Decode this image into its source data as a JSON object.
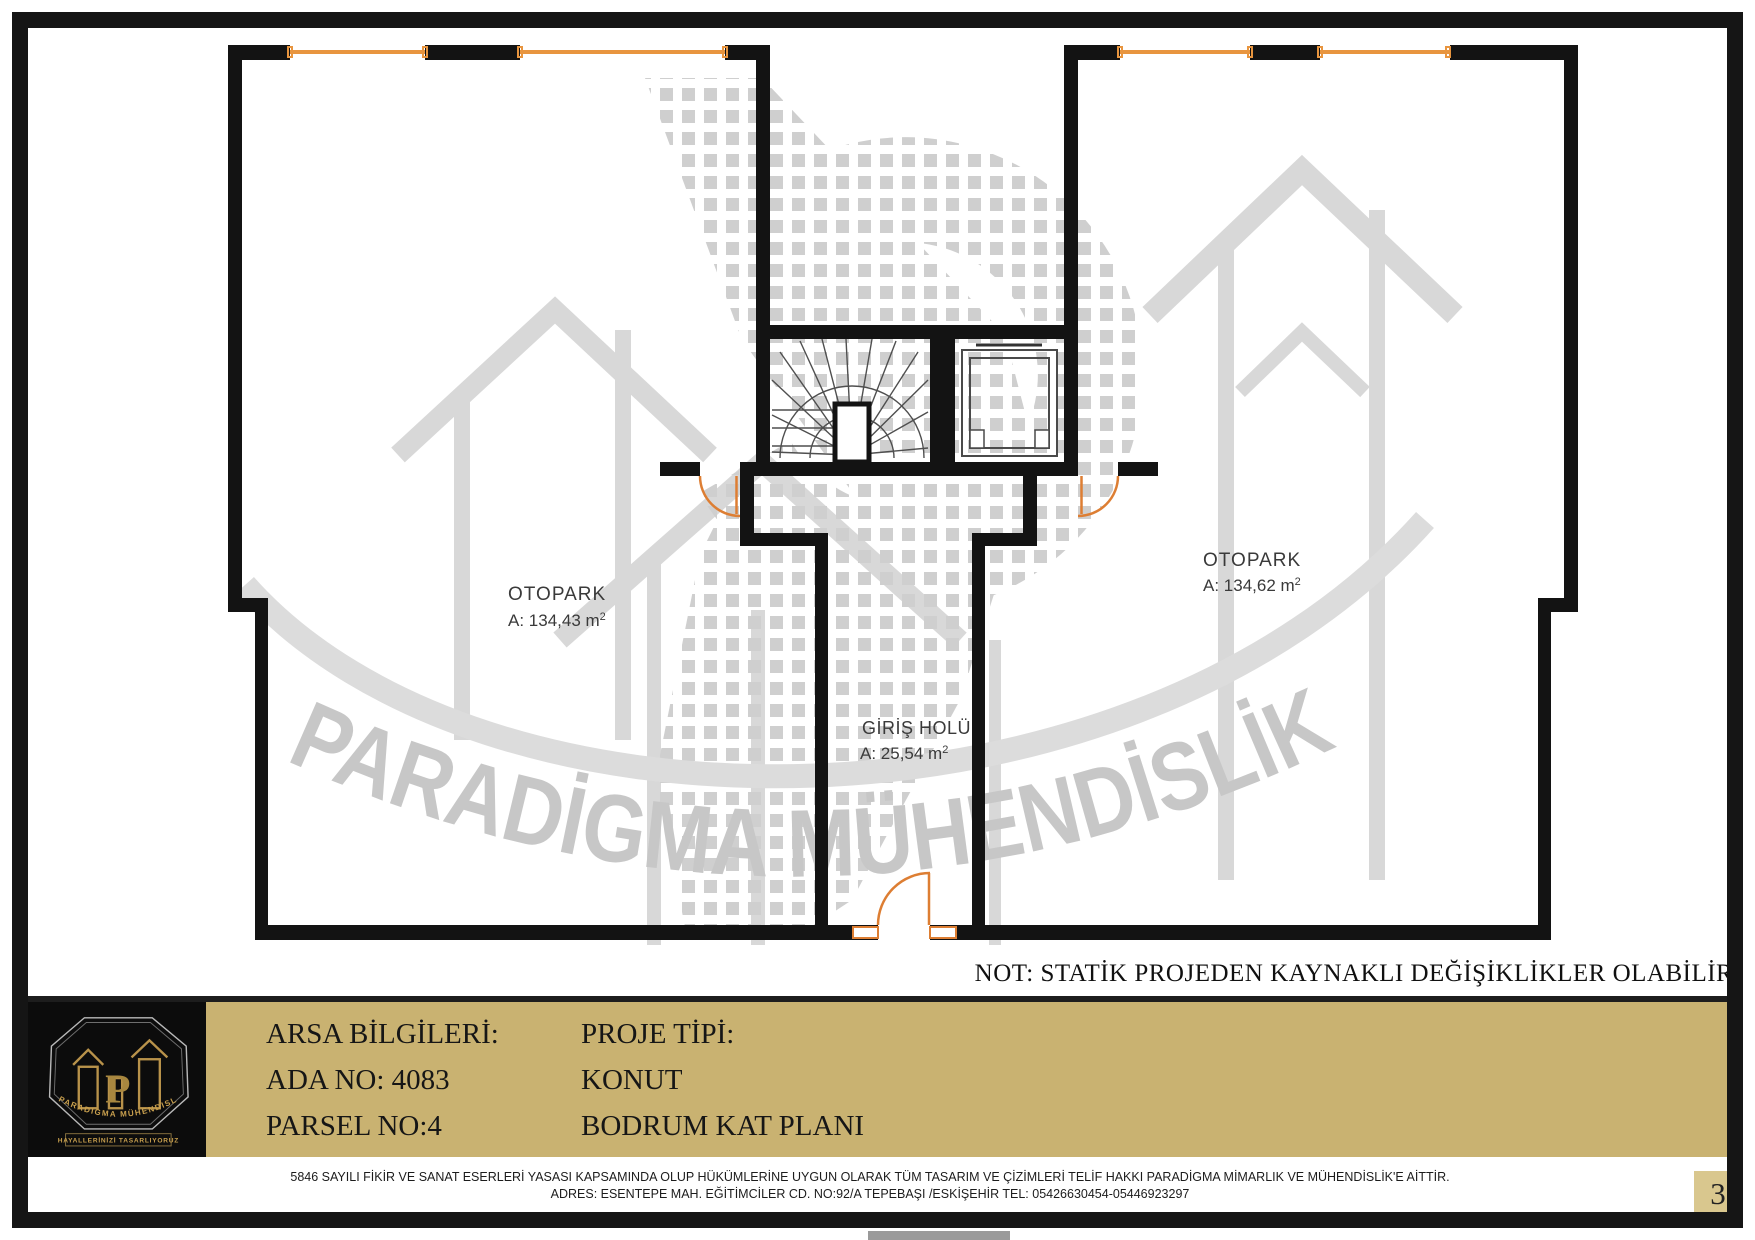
{
  "plan": {
    "rooms": [
      {
        "name": "OTOPARK",
        "area": "A: 134,43 m",
        "area_sup": "2"
      },
      {
        "name": "OTOPARK",
        "area": "A: 134,62 m",
        "area_sup": "2"
      },
      {
        "name": "GİRİŞ HOLÜ",
        "area": "A:  25,54 m",
        "area_sup": "2"
      }
    ],
    "note": "NOT: STATİK PROJEDEN KAYNAKLI DEĞİŞİKLİKLER OLABİLİR."
  },
  "watermark": {
    "text": "PARADİGMA  MÜHENDİSLİK"
  },
  "title_block": {
    "left_col": {
      "line1": "ARSA BİLGİLERİ:",
      "line2": "ADA NO: 4083",
      "line3": "PARSEL NO:4"
    },
    "right_col": {
      "line1": "PROJE TİPİ:",
      "line2": "KONUT",
      "line3": "BODRUM  KAT PLANI"
    }
  },
  "logo": {
    "brand": "PARADIGMA MÜHENDISLIK",
    "tagline": "HAYALLERİNİZİ TASARLIYORUZ",
    "monogram": "P"
  },
  "footer": {
    "line1": "5846 SAYILI FİKİR VE SANAT ESERLERİ YASASI KAPSAMINDA OLUP HÜKÜMLERİNE UYGUN OLARAK TÜM TASARIM VE ÇİZİMLERİ TELİF HAKKI PARADİGMA MİMARLIK VE MÜHENDİSLİK'E AİTTİR.",
    "line2": "ADRES: ESENTEPE MAH. EĞİTİMCİLER CD. NO:92/A TEPEBAŞI /ESKİŞEHİR TEL: 05426630454-05446923297",
    "page_number": "3"
  },
  "colors": {
    "wall_black": "#131313",
    "window_orange": "#e8953f",
    "door_orange": "#dd7e33",
    "watermark_gray": "#d2d2d2",
    "panel_tan": "#c9b271",
    "logo_gold": "#b8924a"
  }
}
